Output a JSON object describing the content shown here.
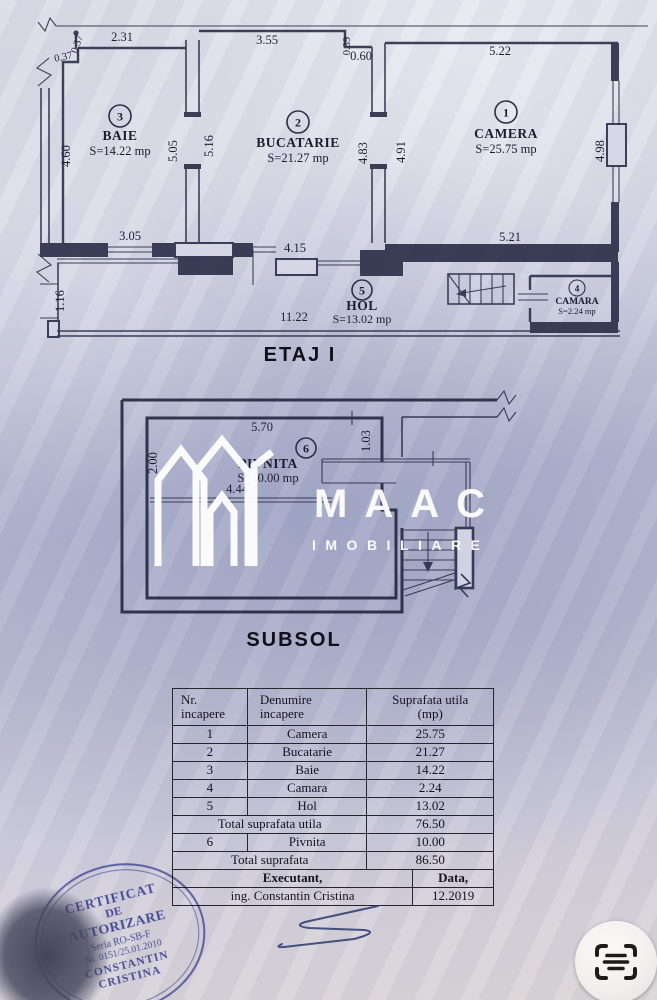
{
  "etaj": {
    "title": "ETAJ I",
    "rooms": {
      "camera": {
        "num": "1",
        "name": "CAMERA",
        "area": "S=25.75 mp"
      },
      "bucatarie": {
        "num": "2",
        "name": "BUCATARIE",
        "area": "S=21.27 mp"
      },
      "baie": {
        "num": "3",
        "name": "BAIE",
        "area": "S=14.22 mp"
      },
      "camara": {
        "num": "4",
        "name": "CAMARA",
        "area": "S=2.24 mp"
      },
      "hol": {
        "num": "5",
        "name": "HOL",
        "area": "S=13.02 mp"
      }
    },
    "dims": {
      "baie_top": "2.31",
      "baie_step_v": "0.37",
      "baie_step_h": "0.37",
      "baie_left": "4.60",
      "baie_right": "5.05",
      "baie_bottom": "3.05",
      "buc_left": "5.16",
      "buc_top": "3.55",
      "buc_step_v": "0.39",
      "buc_step_h": "0.60",
      "buc_right": "4.83",
      "buc_bottom": "4.15",
      "camera_top": "5.22",
      "camera_left": "4.91",
      "camera_right": "4.98",
      "camera_bottom": "5.21",
      "hol_left": "1.16",
      "hol_width": "11.22"
    }
  },
  "subsol": {
    "title": "SUBSOL",
    "rooms": {
      "pivnita": {
        "num": "6",
        "name": "PIVNITA",
        "area": "S=10.00 mp"
      }
    },
    "dims": {
      "top": "5.70",
      "left": "2.00",
      "right": "1.03",
      "inner": "4.44"
    }
  },
  "watermark": {
    "brand": "MAAC",
    "subtitle": "IMOBILIARE"
  },
  "table": {
    "header": {
      "c1a": "Nr.",
      "c1b": "incapere",
      "c2a": "Denumire",
      "c2b": "incapere",
      "c3a": "Suprafata utila",
      "c3b": "(mp)"
    },
    "rows": [
      {
        "nr": "1",
        "name": "Camera",
        "val": "25.75"
      },
      {
        "nr": "2",
        "name": "Bucatarie",
        "val": "21.27"
      },
      {
        "nr": "3",
        "name": "Baie",
        "val": "14.22"
      },
      {
        "nr": "4",
        "name": "Camara",
        "val": "2.24"
      },
      {
        "nr": "5",
        "name": "Hol",
        "val": "13.02"
      }
    ],
    "total_utila": {
      "label": "Total suprafata utila",
      "val": "76.50"
    },
    "row6": {
      "nr": "6",
      "name": "Pivnita",
      "val": "10.00"
    },
    "total": {
      "label": "Total suprafata",
      "val": "86.50"
    },
    "executant_label": "Executant,",
    "data_label": "Data,",
    "executant_name": "ing. Constantin Cristina",
    "date": "12.2019"
  },
  "stamp": {
    "l1": "CERTIFICAT",
    "l2": "DE",
    "l3": "AUTORIZARE",
    "l4": "Seria RO-SB-F",
    "l5": "Nr. 0151/25.01.2010",
    "l6": "CONSTANTIN",
    "l7": "CRISTINA"
  },
  "colors": {
    "stamp_blue": "#3c4aa5",
    "line": "#2c2f4a",
    "paper_light": "#dcdde8",
    "paper_mid": "#b7bbd3"
  }
}
